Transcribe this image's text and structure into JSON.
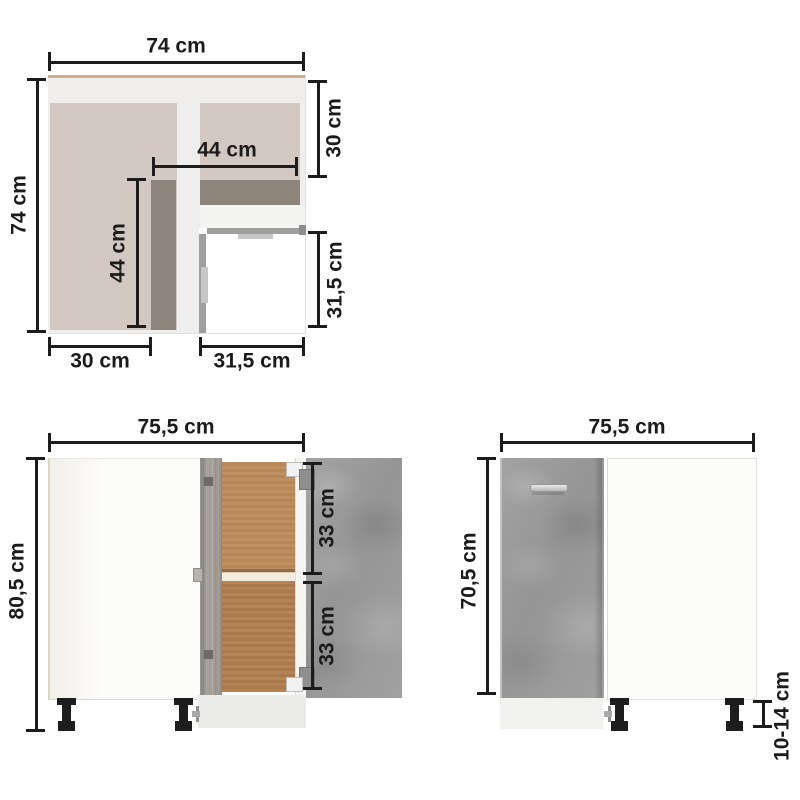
{
  "top_view": {
    "dim_width": "74 cm",
    "dim_depth": "74 cm",
    "dim_right_top": "30 cm",
    "dim_inner_width": "44 cm",
    "dim_inner_depth": "44 cm",
    "dim_right_bottom": "31,5 cm",
    "dim_bottom_left": "30 cm",
    "dim_bottom_right": "31,5 cm"
  },
  "front_open": {
    "dim_width": "75,5 cm",
    "dim_height": "80,5 cm",
    "dim_shelf_upper": "33 cm",
    "dim_shelf_lower": "33 cm"
  },
  "front_closed": {
    "dim_width": "75,5 cm",
    "dim_height": "70,5 cm",
    "dim_leg_height": "10-14 cm"
  },
  "colors": {
    "dimension_ink": "#1c1c1c",
    "cabinet_white": "#fbfbfa",
    "concrete_grey": "#9d9d9d",
    "sonoma_grey_door": "#a09a92",
    "wood_interior_upper": "#bc8a58",
    "wood_interior_lower": "#b07d4d",
    "beige_panel": "#d2c8c1",
    "taupe_strip": "#8d847b",
    "oak_edge": "#c9ae87",
    "leg_black": "#1d1d1d"
  }
}
